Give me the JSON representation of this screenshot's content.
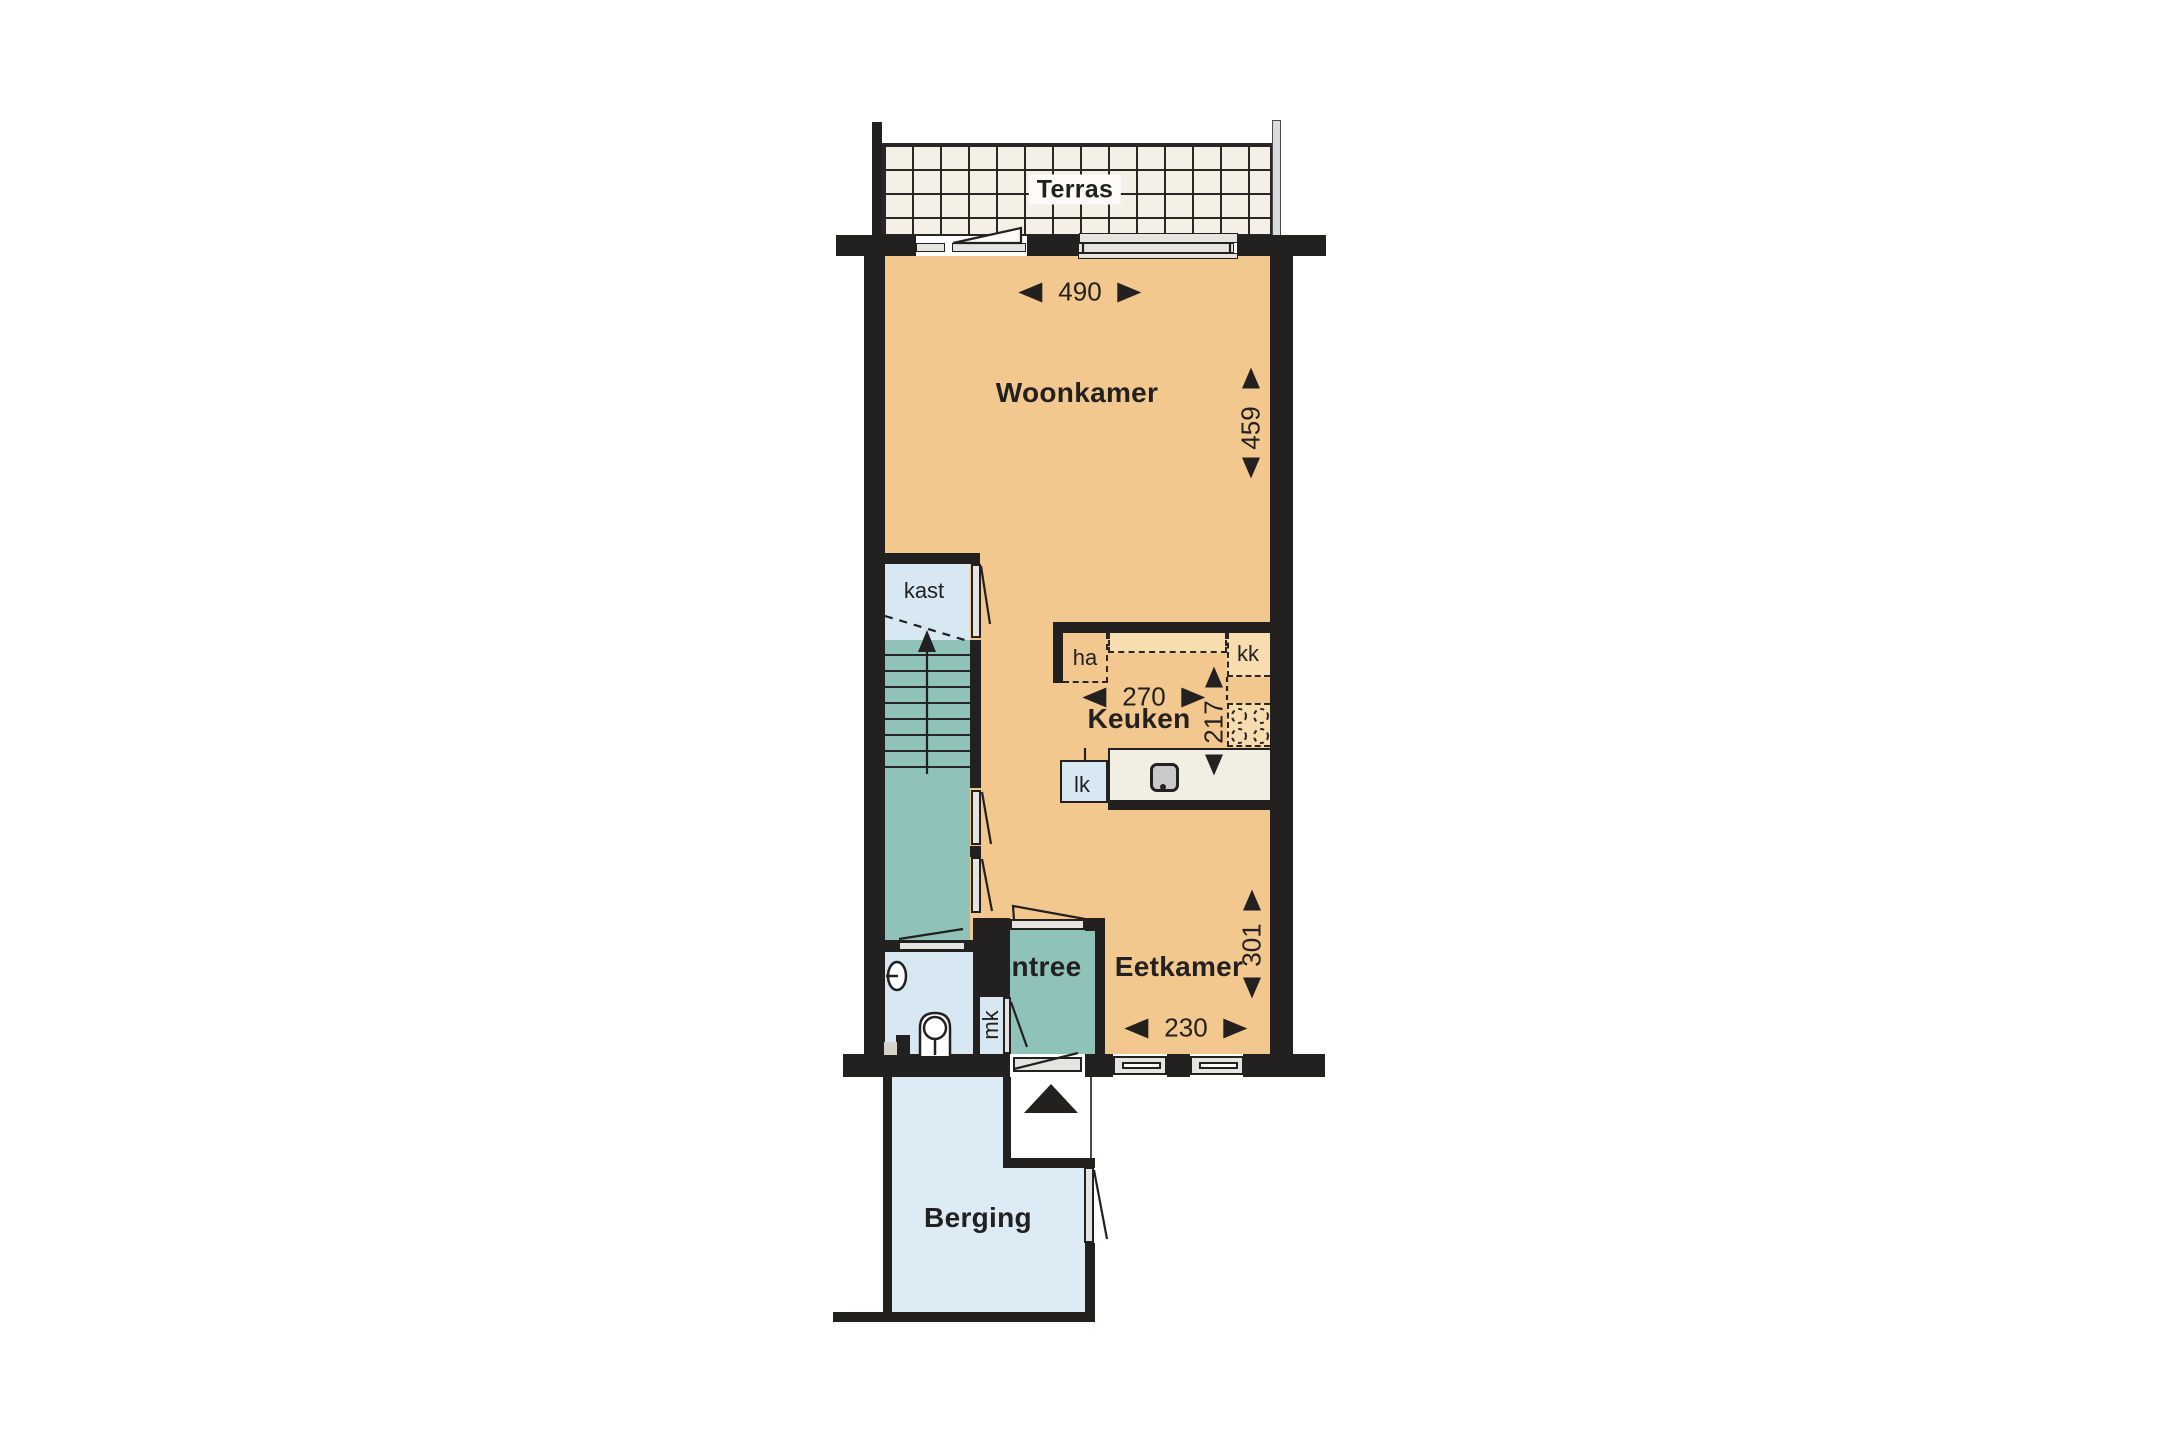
{
  "rooms": {
    "terras": {
      "label": "Terras"
    },
    "woonkamer": {
      "label": "Woonkamer"
    },
    "keuken": {
      "label": "Keuken"
    },
    "eetkamer": {
      "label": "Eetkamer"
    },
    "entree": {
      "label": "Entree"
    },
    "berging": {
      "label": "Berging"
    }
  },
  "closets": {
    "kast": "kast",
    "mk": "mk"
  },
  "appliances": {
    "ha": "ha",
    "kk": "kk",
    "lk": "lk"
  },
  "dimensions": {
    "woonkamer_width": "490",
    "woonkamer_depth": "459",
    "keuken_width": "270",
    "keuken_depth": "217",
    "eetkamer_width": "230",
    "eetkamer_depth": "301"
  },
  "colors": {
    "wall": "#232020",
    "line": "#2A2628",
    "floor_orange": "#F3C88E",
    "floor_teal": "#8FC3BA",
    "floor_light_blue": "#D7E8F2",
    "floor_berging_blue": "#DCEBF4",
    "cabinet_beige": "#F6DCAE",
    "counter_cream": "#F1EEE3",
    "terrace_tile": "#F4F0E5",
    "door_fill": "#E6E4E0",
    "sink_gray": "#C9C9C9"
  }
}
